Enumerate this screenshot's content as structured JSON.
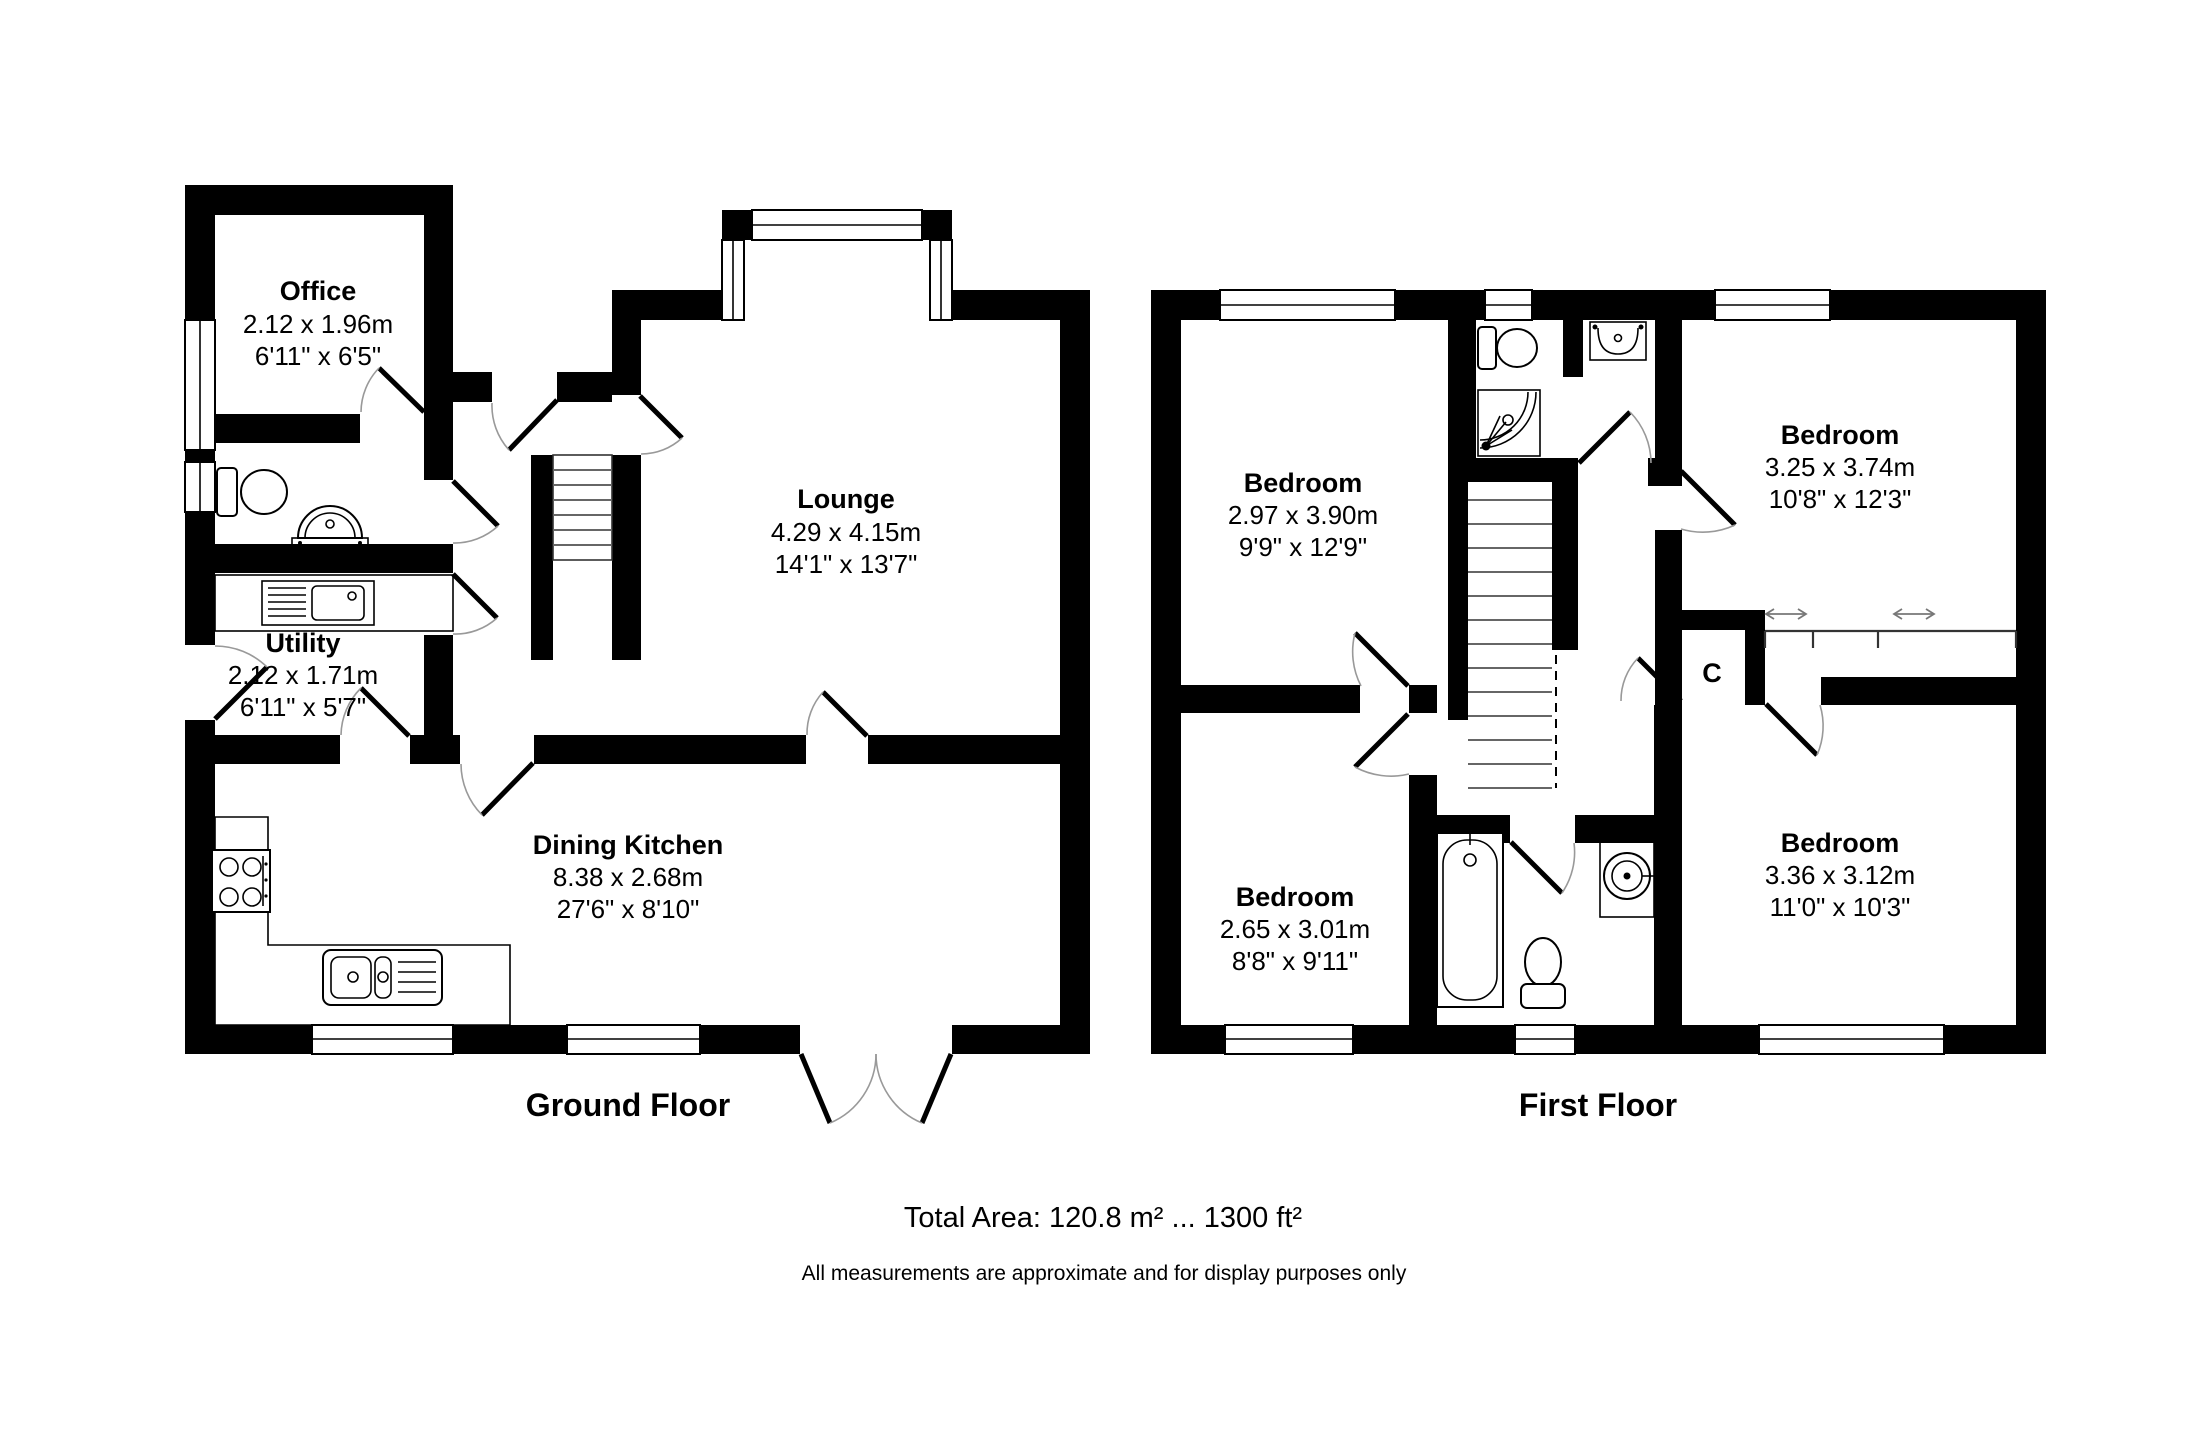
{
  "page": {
    "background": "#ffffff",
    "wall_color": "#000000"
  },
  "ground_floor": {
    "caption": "Ground Floor",
    "rooms": {
      "office": {
        "name": "Office",
        "metric": "2.12 x 1.96m",
        "imperial": "6'11\" x 6'5\""
      },
      "lounge": {
        "name": "Lounge",
        "metric": "4.29 x 4.15m",
        "imperial": "14'1\" x 13'7\""
      },
      "utility": {
        "name": "Utility",
        "metric": "2.12 x 1.71m",
        "imperial": "6'11\" x 5'7\""
      },
      "dining_kitchen": {
        "name": "Dining Kitchen",
        "metric": "8.38 x 2.68m",
        "imperial": "27'6\" x 8'10\""
      }
    }
  },
  "first_floor": {
    "caption": "First Floor",
    "rooms": {
      "bedroom_top_left": {
        "name": "Bedroom",
        "metric": "2.97 x 3.90m",
        "imperial": "9'9\" x 12'9\""
      },
      "bedroom_top_right": {
        "name": "Bedroom",
        "metric": "3.25 x 3.74m",
        "imperial": "10'8\" x 12'3\""
      },
      "bedroom_bottom_left": {
        "name": "Bedroom",
        "metric": "2.65 x 3.01m",
        "imperial": "8'8\" x 9'11\""
      },
      "bedroom_bottom_right": {
        "name": "Bedroom",
        "metric": "3.36 x 3.12m",
        "imperial": "11'0\" x 10'3\""
      },
      "cupboard": {
        "label": "C"
      }
    }
  },
  "footer": {
    "total_area": "Total Area: 120.8 m² ... 1300 ft²",
    "disclaimer": "All measurements are approximate and for display purposes only"
  }
}
